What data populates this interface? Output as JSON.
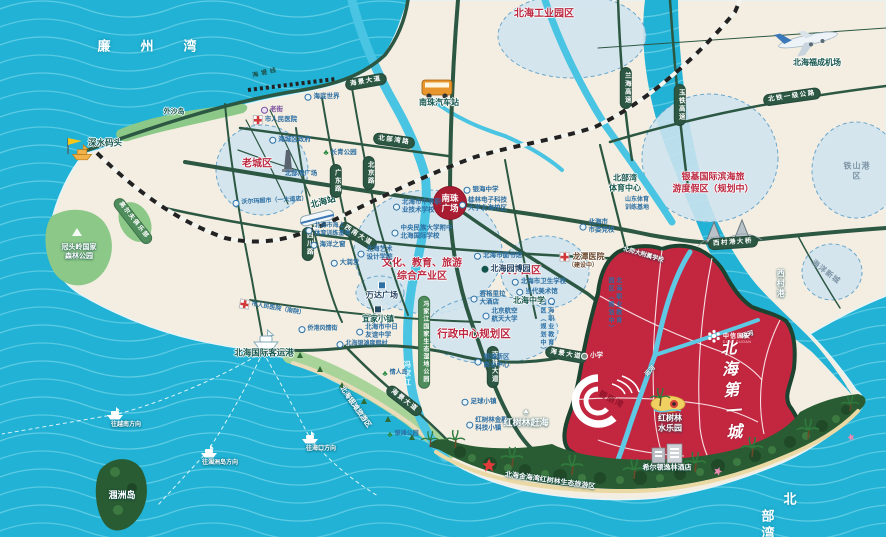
{
  "colors": {
    "sea": "#21b2d5",
    "land": "#f3eee1",
    "road": "#2c5743",
    "project_red": "#c32740",
    "planning_blue": "#cfe4ee",
    "accent_red": "#bc2840",
    "mangrove": "#2a5c33"
  },
  "sea": {
    "lianzhou_bay": "廉州湾",
    "beibu_gulf": "北部湾",
    "weizhou_island": "涠洲岛",
    "xicun_port": "西村港"
  },
  "ferry": {
    "to_vietnam": "往越南方向",
    "to_weizhou": "往涠洲岛方向",
    "to_haikou": "往海口方向"
  },
  "ports": {
    "shenshui_wharf": "深水码头",
    "intl_passenger_port": "北海国际客运港"
  },
  "transport": {
    "nanzhu_bus_station": "南珠汽车站",
    "beihai_station": "北海站",
    "fucheng_airport": "北海福成机场"
  },
  "roads": {
    "haijing_avenue": "海景大道",
    "haidi_line": "海堤线",
    "beibuwan_road": "北部湾路",
    "sichuan_road": "四川路",
    "guangdong_road": "广东路",
    "beijing_road": "北京路",
    "xinan_avenue": "西南大道",
    "nanzhu_avenue": "南珠大道",
    "xicungang_bridge": "西村港大桥",
    "lanhai_expressway": "兰海高速",
    "yutie_expressway": "玉铁高速",
    "beitie_highway": "北铁一级公路"
  },
  "areas": {
    "old_town": "老城区",
    "industrial_park": "北海工业园区",
    "yinji_resort": "银基国际滨海旅\n游度假区（规划中）",
    "tieshangang": "铁山港区",
    "ocean_newcity": "海洋新城",
    "culture_zone": "文化、教育、旅游\n综合产业区",
    "university_zone": "大学园区",
    "admin_zone": "行政中心规划区",
    "vocational_park": "北海职业教育\n园区（规划中）",
    "yintan_tourist_zone": "北海银滩旅游区",
    "guantouling": "冠头岭国家\n森林公园",
    "golf_club": "高尔夫俱乐部",
    "waishadao": "外沙岛",
    "fengjiajiang_park": "冯家江国家生态湿地公园",
    "fengjiajiang_river": "冯家江",
    "jinhaiwan_mangrove": "北海金海湾红树林生态旅游区",
    "canal": "运河",
    "nanzhu_square": "南珠\n广场"
  },
  "pois": {
    "laojie": "老街",
    "renmin_hospital": "市人民医院",
    "renmin_hospital_south": "市人民医院（南院）",
    "haicheng_gov": "海城区政府",
    "changqing_park": "长青公园",
    "beibuwan_square": "北部湾广场",
    "haidi_world": "海底世界",
    "walmart": "沃尔玛超市（一大道店）",
    "haiyang_window": "海洋之窗",
    "darunfa": "大润发",
    "marine_training": "北海市海上\n体育训练基地",
    "zhongzhi_school": "北海市中等职\n业技术学校",
    "minzu_school": "中央民族大学附中\n北海国际学校",
    "yinhai_school": "银海中学",
    "guilin_univ": "桂林电子科技\n大学北海校区",
    "art_college": "北海艺术\n设计学院",
    "library": "北海市图书馆",
    "yuanbo_garden": "北海园博园",
    "health_school": "北海市卫生学校",
    "art_museum": "当代美术馆",
    "beihai_middle": "北海中学",
    "party_school": "北海市\n市委党校",
    "longtan_hospital": "龙潭医院",
    "longtan_status": "（建设中）",
    "shandong_base": "山东体育\n训练基地",
    "beihang": "北京航空\n航天大学",
    "shangrila": "香格里拉\n大酒店",
    "yintan_biz": "银滩新区\n商业中心",
    "wanda": "万达广场",
    "yijia_town": "宜家小镇",
    "zhongri_school": "北海市中日\n友谊中学",
    "yintan_resort_village": "北海银滩度假村",
    "qiaogang_street": "侨港风情街",
    "lovers_island": "情人岛",
    "yintan_park": "银滩公园",
    "football_town": "足球小镇",
    "mangrove_fintech": "红树林金融\n科技小镇",
    "primary_school": "小学",
    "shida_school": "北师大附属学校",
    "mangrove_ganhai": "红树林赶海",
    "mangrove_waterpark": "红树林\n水乐园",
    "hilton": "希尔顿逸林酒店",
    "beibuwan_sports": "北部湾\n体育中心"
  },
  "project": {
    "brand": "中信国安",
    "brand_en": "CITIC GUOAN",
    "name": "北海第一城",
    "bili_bay": "碧丽湾"
  }
}
